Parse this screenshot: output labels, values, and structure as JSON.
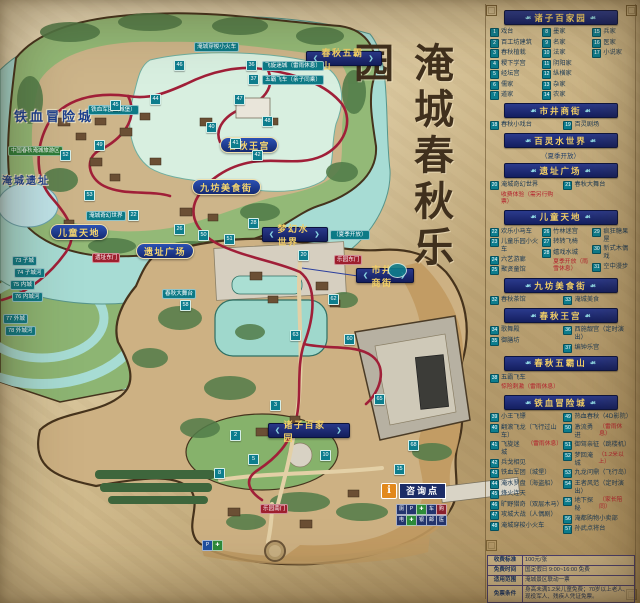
{
  "title": "淹城春秋乐园",
  "map": {
    "area_labels": [
      {
        "text": "春秋五霸山",
        "style": "banner",
        "x": 306,
        "y": 51,
        "w": 74
      },
      {
        "text": "梦幻水世界",
        "style": "banner",
        "x": 262,
        "y": 227,
        "w": 64
      },
      {
        "text": "市井商街",
        "style": "banner",
        "x": 356,
        "y": 268,
        "w": 56
      },
      {
        "text": "诸子百家园",
        "style": "banner",
        "x": 268,
        "y": 423,
        "w": 80
      },
      {
        "text": "春秋王宫",
        "style": "pill",
        "x": 220,
        "y": 137
      },
      {
        "text": "九坊美食街",
        "style": "pill",
        "x": 192,
        "y": 179
      },
      {
        "text": "儿童天地",
        "style": "pill",
        "x": 50,
        "y": 224
      },
      {
        "text": "遗址广场",
        "style": "pill",
        "x": 136,
        "y": 243
      },
      {
        "text": "铁血冒险城",
        "style": "text",
        "x": 14,
        "y": 106
      },
      {
        "text": "淹城遗址",
        "style": "text-small",
        "x": 2,
        "y": 172
      }
    ],
    "season_tag": {
      "text": "（夏季开放）",
      "x": 330,
      "y": 230
    },
    "ring_badges": [
      {
        "text": "73 子城",
        "x": 12,
        "y": 256
      },
      {
        "text": "74 子城河",
        "x": 14,
        "y": 268
      },
      {
        "text": "75 内城",
        "x": 10,
        "y": 280
      },
      {
        "text": "76 内城河",
        "x": 12,
        "y": 292
      },
      {
        "text": "77 外城",
        "x": 3,
        "y": 314
      },
      {
        "text": "78 外城河",
        "x": 5,
        "y": 326
      }
    ],
    "gate_badges": [
      {
        "text": "遗址东门",
        "x": 92,
        "y": 253
      },
      {
        "text": "乐园东门",
        "x": 334,
        "y": 255
      },
      {
        "text": "乐园南门",
        "x": 260,
        "y": 504
      }
    ],
    "green_badge": {
      "text": "中国春秋淹城旅游区",
      "x": 8,
      "y": 146
    },
    "tags": [
      {
        "text": "飞旋迷城（雷雨休息）",
        "x": 262,
        "y": 61
      },
      {
        "text": "五霸飞车（亲子同乘）",
        "x": 262,
        "y": 75
      },
      {
        "text": "铁血军团（城堡）",
        "x": 88,
        "y": 105
      },
      {
        "text": "淹城穿梭小火车",
        "x": 194,
        "y": 42
      },
      {
        "text": "淹城奇幻世界",
        "x": 86,
        "y": 211
      },
      {
        "text": "春秋大舞台",
        "x": 162,
        "y": 289
      }
    ],
    "markers": [
      [
        36,
        246,
        60
      ],
      [
        37,
        248,
        74
      ],
      [
        44,
        150,
        94
      ],
      [
        45,
        110,
        100
      ],
      [
        46,
        174,
        60
      ],
      [
        47,
        234,
        94
      ],
      [
        48,
        262,
        116
      ],
      [
        40,
        206,
        122
      ],
      [
        41,
        230,
        138
      ],
      [
        42,
        252,
        150
      ],
      [
        49,
        94,
        140
      ],
      [
        52,
        60,
        150
      ],
      [
        53,
        84,
        190
      ],
      [
        22,
        128,
        210
      ],
      [
        26,
        174,
        224
      ],
      [
        28,
        248,
        218
      ],
      [
        50,
        198,
        230
      ],
      [
        51,
        224,
        234
      ],
      [
        20,
        298,
        250
      ],
      [
        58,
        180,
        300
      ],
      [
        62,
        328,
        294
      ],
      [
        63,
        290,
        330
      ],
      [
        60,
        344,
        334
      ],
      [
        65,
        374,
        394
      ],
      [
        68,
        408,
        440
      ],
      [
        2,
        230,
        430
      ],
      [
        3,
        270,
        400
      ],
      [
        5,
        248,
        454
      ],
      [
        8,
        214,
        468
      ],
      [
        10,
        320,
        450
      ],
      [
        15,
        394,
        464
      ]
    ],
    "info_point": {
      "icon": "i",
      "label": "咨询点",
      "x": 381,
      "y": 483
    },
    "facility_rows": [
      [
        "厕",
        "P",
        "✚",
        "车",
        "购"
      ],
      [
        "电",
        "✚",
        "银",
        "邮",
        "医"
      ]
    ],
    "facility_colors": [
      [
        "#24356e",
        "#24356e",
        "#2e8b3a",
        "#24356e",
        "#8a1f2e"
      ],
      [
        "#24356e",
        "#2e8b3a",
        "#24356e",
        "#24356e",
        "#24356e"
      ]
    ],
    "parking_cluster": {
      "x": 202,
      "y": 540,
      "items": [
        {
          "g": "P",
          "c": "#1f4fa0"
        },
        {
          "g": "✚",
          "c": "#2e8b3a"
        }
      ]
    }
  },
  "legend": {
    "sections": [
      {
        "title": "诸子百家园",
        "columns": [
          [
            {
              "n": 1,
              "label": "戏台"
            },
            {
              "n": 2,
              "label": "百工坊建筑"
            },
            {
              "n": 3,
              "label": "春秋植栽"
            },
            {
              "n": 4,
              "label": "稷下学宫"
            },
            {
              "n": 5,
              "label": "经坛宫"
            },
            {
              "n": 6,
              "label": "儒家"
            },
            {
              "n": 7,
              "label": "道家"
            }
          ],
          [
            {
              "n": 8,
              "label": "墨家"
            },
            {
              "n": 9,
              "label": "名家"
            },
            {
              "n": 10,
              "label": "法家"
            },
            {
              "n": 11,
              "label": "阴阳家"
            },
            {
              "n": 12,
              "label": "纵横家"
            },
            {
              "n": 13,
              "label": "杂家"
            },
            {
              "n": 14,
              "label": "农家"
            }
          ],
          [
            {
              "n": 15,
              "label": "兵家"
            },
            {
              "n": 16,
              "label": "医家"
            },
            {
              "n": 17,
              "label": "小说家"
            }
          ]
        ]
      },
      {
        "title": "市井商街",
        "columns": [
          [
            {
              "n": 18,
              "label": "春秋小戏台"
            }
          ],
          [
            {
              "n": 19,
              "label": "百灵剧场"
            }
          ]
        ]
      },
      {
        "title": "百灵水世界",
        "subtitle": "（夏季开放）"
      },
      {
        "title": "遗址广场",
        "columns": [
          [
            {
              "n": 20,
              "label": "淹城奇幻世界",
              "blocknote": "收费体验（需另行购票）"
            }
          ],
          [
            {
              "n": 21,
              "label": "春秋大舞台"
            }
          ]
        ]
      },
      {
        "title": "儿童天地",
        "columns": [
          [
            {
              "n": 22,
              "label": "欢乐小马车"
            },
            {
              "n": 23,
              "label": "儿童乐园小火车"
            },
            {
              "n": 24,
              "label": "六艺游廊"
            },
            {
              "n": 25,
              "label": "聚贤童馆"
            }
          ],
          [
            {
              "n": 26,
              "label": "竹林迷宫"
            },
            {
              "n": 27,
              "label": "转转飞椅"
            },
            {
              "n": 28,
              "label": "嬉戏水城",
              "blocknote": "夏季开放（雨雪休息）"
            }
          ],
          [
            {
              "n": 29,
              "label": "疯狂糖果屋"
            },
            {
              "n": 30,
              "label": "新式木偶戏"
            },
            {
              "n": 31,
              "label": "空中漫步"
            }
          ]
        ]
      },
      {
        "title": "九坊美食街",
        "columns": [
          [
            {
              "n": 32,
              "label": "春秋茶馆"
            }
          ],
          [
            {
              "n": 33,
              "label": "淹城美食"
            }
          ]
        ]
      },
      {
        "title": "春秋王宫",
        "columns": [
          [
            {
              "n": 34,
              "label": "歌舞殿"
            },
            {
              "n": 35,
              "label": "御膳坊"
            }
          ],
          [
            {
              "n": 36,
              "label": "西施靓宫（定时演出）"
            },
            {
              "n": 37,
              "label": "编钟乐宫"
            }
          ]
        ]
      },
      {
        "title": "春秋五霸山",
        "columns": [
          [
            {
              "n": 38,
              "label": "五霸飞车",
              "blocknote": "惊险刺激（雷雨休息）"
            }
          ]
        ]
      },
      {
        "title": "铁血冒险城",
        "columns": [
          [
            {
              "n": 39,
              "label": "小王飞镖"
            },
            {
              "n": 40,
              "label": "翻滚飞龙（飞行过山车）"
            },
            {
              "n": 41,
              "label": "飞旋迷城",
              "note": "（雷雨休息）"
            },
            {
              "n": 42,
              "label": "兵戈相见"
            },
            {
              "n": 43,
              "label": "铁血军团（城堡）"
            },
            {
              "n": 44,
              "label": "淹水罗盘（海盗船）"
            },
            {
              "n": 45,
              "label": "烽火连天"
            },
            {
              "n": 46,
              "label": "旷野猎奇（双层木马）"
            },
            {
              "n": 47,
              "label": "攻城大战（人偶剧）"
            },
            {
              "n": 48,
              "label": "淹城穿梭小火车"
            }
          ],
          [
            {
              "n": 49,
              "label": "热血春秋（4D影院）"
            },
            {
              "n": 50,
              "label": "激流勇进",
              "note": "（雷雨休息）"
            },
            {
              "n": 51,
              "label": "御驾亲征（跳楼机）"
            },
            {
              "n": 52,
              "label": "梦回淹城",
              "note": "（1.2米以上）"
            },
            {
              "n": 53,
              "label": "九龙问鼎（飞行岛）"
            },
            {
              "n": 54,
              "label": "王者风范（定时演出）"
            },
            {
              "n": 55,
              "label": "地下探秘",
              "note": "（家长陪同）"
            },
            {
              "n": 56,
              "label": "淹都购物小卖部"
            },
            {
              "n": 57,
              "label": "孙武点将台"
            }
          ]
        ]
      }
    ]
  },
  "info_table": {
    "rows": [
      {
        "label": "收费标准",
        "value": "100元/张"
      },
      {
        "label": "免费时间",
        "value": "国定假日 9:00~16:00 免费"
      },
      {
        "label": "适用范围",
        "value": "淹城景区联动一票"
      },
      {
        "label": "免票条件",
        "value": "身高未满1.2米儿童免费；70岁以上老人、现役军人、残疾人凭证免票。"
      }
    ]
  }
}
